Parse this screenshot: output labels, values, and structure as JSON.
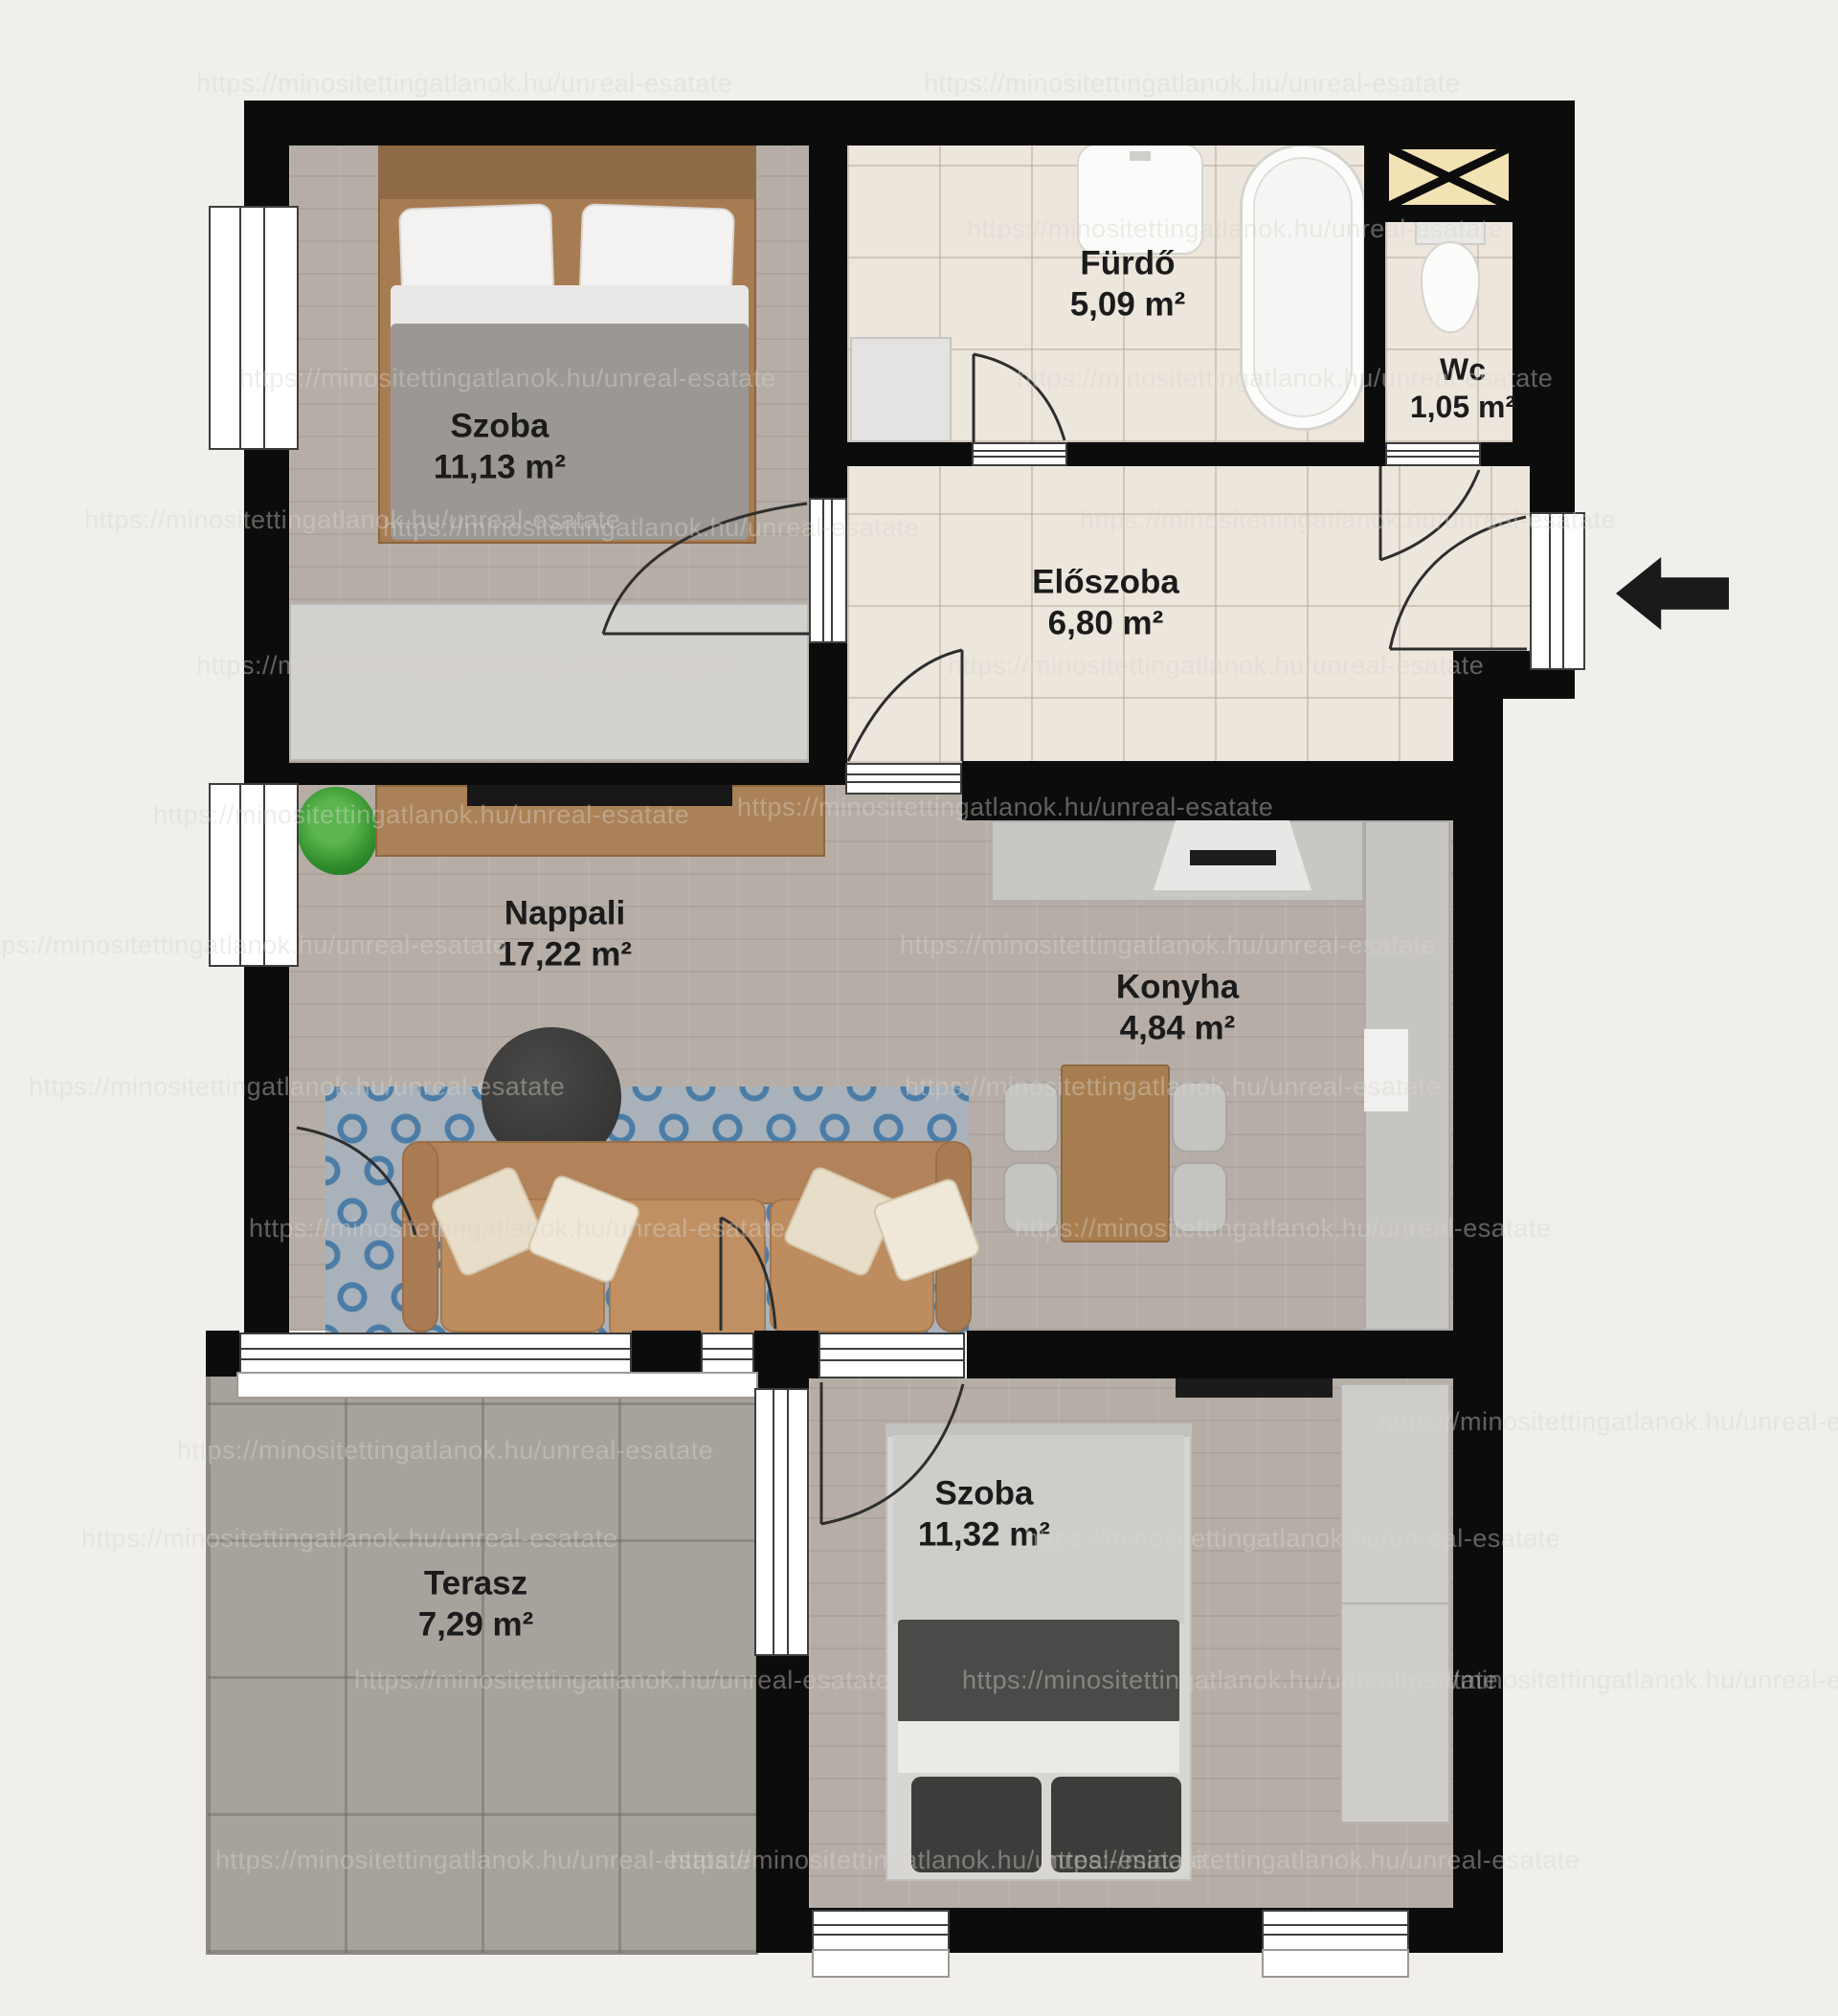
{
  "watermark": {
    "text": "https://minositettingatlanok.hu/unreal-esatate",
    "positions": [
      [
        205,
        72
      ],
      [
        965,
        72
      ],
      [
        1010,
        224
      ],
      [
        250,
        380
      ],
      [
        1062,
        380
      ],
      [
        88,
        528
      ],
      [
        400,
        536
      ],
      [
        1128,
        528
      ],
      [
        205,
        680
      ],
      [
        990,
        680
      ],
      [
        770,
        828
      ],
      [
        160,
        836
      ],
      [
        -30,
        972
      ],
      [
        940,
        972
      ],
      [
        30,
        1120
      ],
      [
        945,
        1120
      ],
      [
        260,
        1268
      ],
      [
        1060,
        1268
      ],
      [
        185,
        1500
      ],
      [
        1440,
        1470
      ],
      [
        85,
        1592
      ],
      [
        1070,
        1592
      ],
      [
        370,
        1740
      ],
      [
        1005,
        1740
      ],
      [
        1440,
        1740
      ],
      [
        225,
        1928
      ],
      [
        700,
        1928
      ],
      [
        1090,
        1928
      ]
    ]
  },
  "rooms": [
    {
      "id": "szoba-1",
      "name": "Szoba",
      "area": "11,13 m²"
    },
    {
      "id": "furdo",
      "name": "Fürdő",
      "area": "5,09 m²"
    },
    {
      "id": "wc",
      "name": "Wc",
      "area": "1,05 m²"
    },
    {
      "id": "eloszoba",
      "name": "Előszoba",
      "area": "6,80 m²"
    },
    {
      "id": "nappali",
      "name": "Nappali",
      "area": "17,22 m²"
    },
    {
      "id": "konyha",
      "name": "Konyha",
      "area": "4,84 m²"
    },
    {
      "id": "terasz",
      "name": "Terasz",
      "area": "7,29 m²"
    },
    {
      "id": "szoba-2",
      "name": "Szoba",
      "area": "11,32 m²"
    }
  ],
  "colors": {
    "wall": "#0c0c0c",
    "background": "#f0efec",
    "wood_floor": "#b6aea6",
    "tile_floor": "#ede6dd",
    "terrace_floor": "#a8a29c",
    "rug_accent": "#4a7ca6",
    "shaft_fill": "#f2e2b4",
    "sofa": "#b2835a"
  },
  "entrance": {
    "arrow_direction": "left"
  }
}
